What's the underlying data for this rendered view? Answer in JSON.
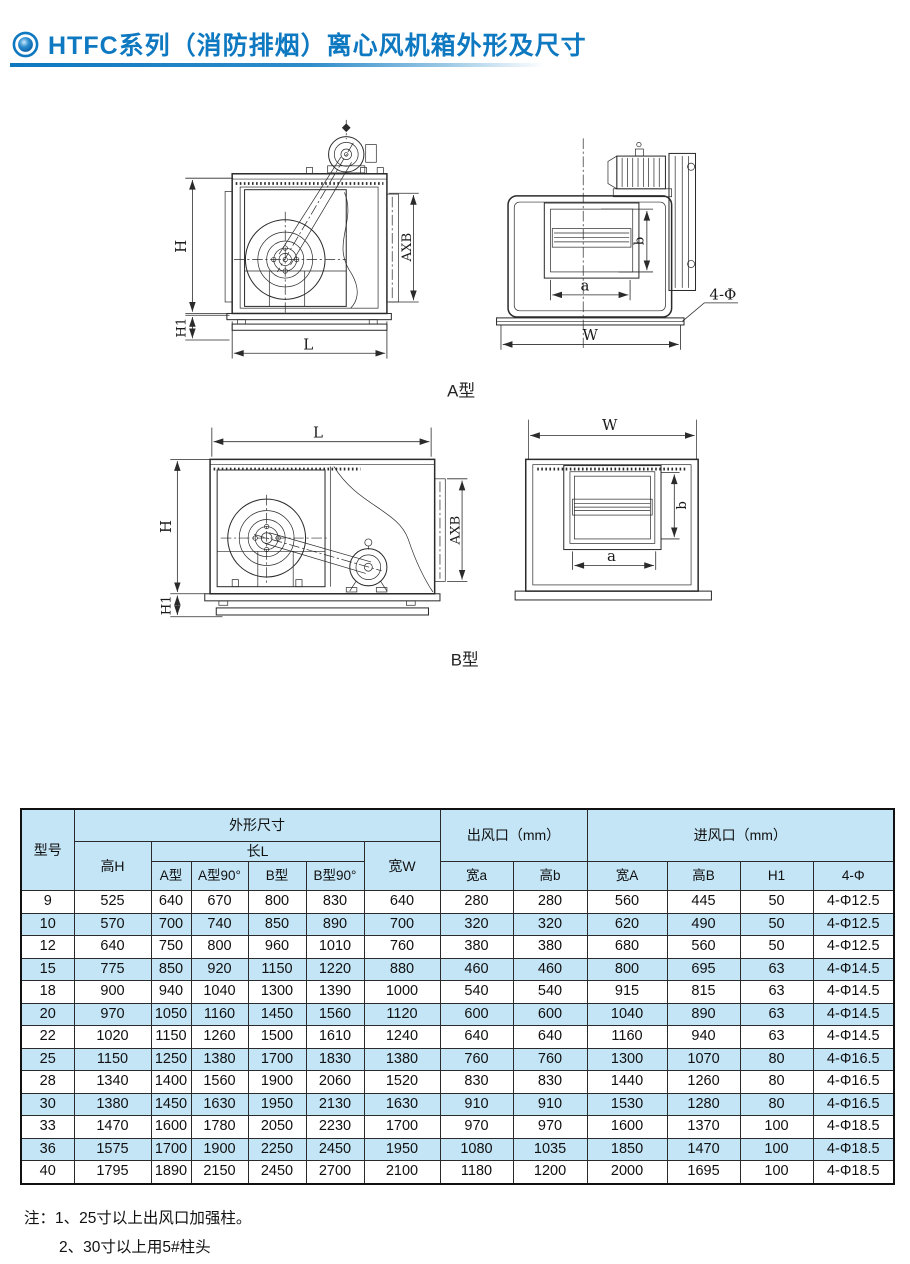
{
  "header": {
    "title": "HTFC系列（消防排烟）离心风机箱外形及尺寸"
  },
  "diagrams": {
    "type_a_label": "A型",
    "type_b_label": "B型",
    "dims": {
      "H": "H",
      "H1": "H1",
      "L": "L",
      "AXB": "AXB",
      "W": "W",
      "a": "a",
      "b": "b",
      "phi4": "4-Φ"
    }
  },
  "table": {
    "header": {
      "model": "型号",
      "outline": "外形尺寸",
      "height_h": "高H",
      "length_l": "长L",
      "type_a": "A型",
      "type_a90": "A型90°",
      "type_b": "B型",
      "type_b90": "B型90°",
      "width_w": "宽W",
      "outlet": "出风口（mm）",
      "outlet_width_a": "宽a",
      "outlet_height_b": "高b",
      "inlet": "进风口（mm）",
      "inlet_width_A": "宽A",
      "inlet_height_B": "高B",
      "h1": "H1",
      "phi": "4-Φ"
    },
    "rows": [
      {
        "model": "9",
        "values": [
          "525",
          "640",
          "670",
          "800",
          "830",
          "640",
          "280",
          "280",
          "560",
          "445",
          "50",
          "4-Φ12.5"
        ]
      },
      {
        "model": "10",
        "values": [
          "570",
          "700",
          "740",
          "850",
          "890",
          "700",
          "320",
          "320",
          "620",
          "490",
          "50",
          "4-Φ12.5"
        ]
      },
      {
        "model": "12",
        "values": [
          "640",
          "750",
          "800",
          "960",
          "1010",
          "760",
          "380",
          "380",
          "680",
          "560",
          "50",
          "4-Φ12.5"
        ]
      },
      {
        "model": "15",
        "values": [
          "775",
          "850",
          "920",
          "1150",
          "1220",
          "880",
          "460",
          "460",
          "800",
          "695",
          "63",
          "4-Φ14.5"
        ]
      },
      {
        "model": "18",
        "values": [
          "900",
          "940",
          "1040",
          "1300",
          "1390",
          "1000",
          "540",
          "540",
          "915",
          "815",
          "63",
          "4-Φ14.5"
        ]
      },
      {
        "model": "20",
        "values": [
          "970",
          "1050",
          "1160",
          "1450",
          "1560",
          "1120",
          "600",
          "600",
          "1040",
          "890",
          "63",
          "4-Φ14.5"
        ]
      },
      {
        "model": "22",
        "values": [
          "1020",
          "1150",
          "1260",
          "1500",
          "1610",
          "1240",
          "640",
          "640",
          "1160",
          "940",
          "63",
          "4-Φ14.5"
        ]
      },
      {
        "model": "25",
        "values": [
          "1150",
          "1250",
          "1380",
          "1700",
          "1830",
          "1380",
          "760",
          "760",
          "1300",
          "1070",
          "80",
          "4-Φ16.5"
        ]
      },
      {
        "model": "28",
        "values": [
          "1340",
          "1400",
          "1560",
          "1900",
          "2060",
          "1520",
          "830",
          "830",
          "1440",
          "1260",
          "80",
          "4-Φ16.5"
        ]
      },
      {
        "model": "30",
        "values": [
          "1380",
          "1450",
          "1630",
          "1950",
          "2130",
          "1630",
          "910",
          "910",
          "1530",
          "1280",
          "80",
          "4-Φ16.5"
        ]
      },
      {
        "model": "33",
        "values": [
          "1470",
          "1600",
          "1780",
          "2050",
          "2230",
          "1700",
          "970",
          "970",
          "1600",
          "1370",
          "100",
          "4-Φ18.5"
        ]
      },
      {
        "model": "36",
        "values": [
          "1575",
          "1700",
          "1900",
          "2250",
          "2450",
          "1950",
          "1080",
          "1035",
          "1850",
          "1470",
          "100",
          "4-Φ18.5"
        ]
      },
      {
        "model": "40",
        "values": [
          "1795",
          "1890",
          "2150",
          "2450",
          "2700",
          "2100",
          "1180",
          "1200",
          "2000",
          "1695",
          "100",
          "4-Φ18.5"
        ]
      }
    ]
  },
  "notes": {
    "prefix": "注：",
    "items": [
      "1、25寸以上出风口加强柱。",
      "2、30寸以上用5#柱头"
    ]
  }
}
